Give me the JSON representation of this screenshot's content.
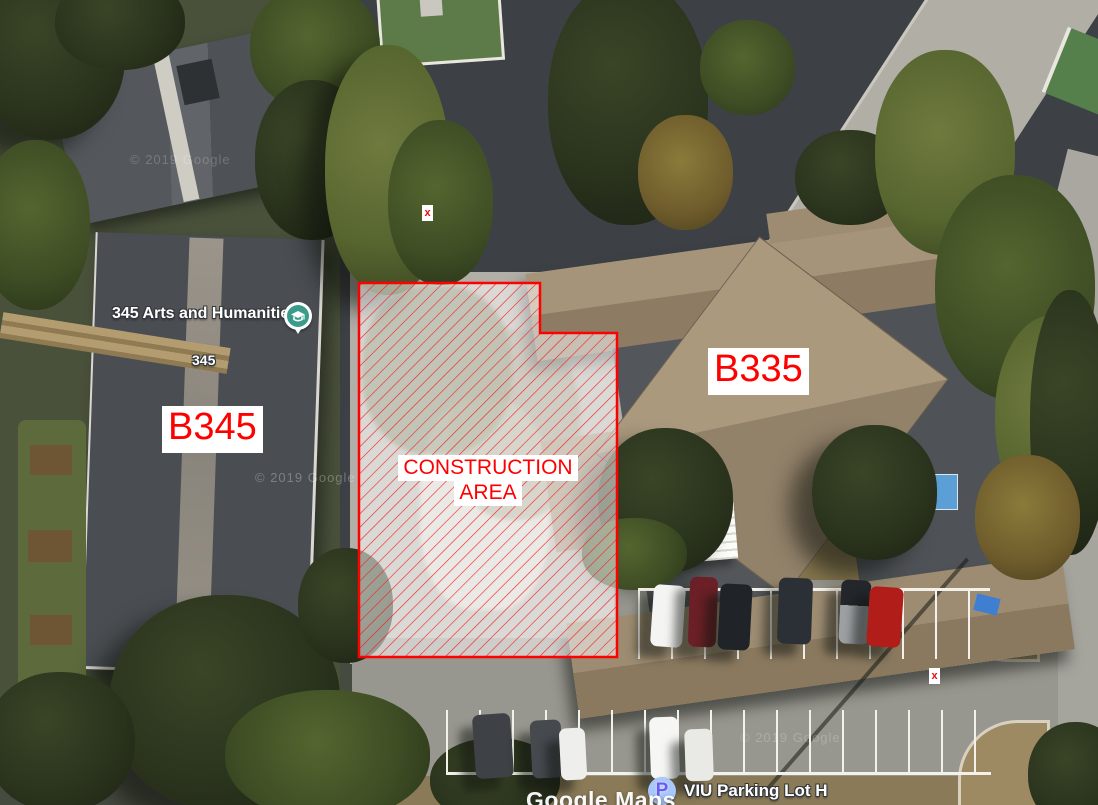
{
  "scene": {
    "view": "aerial-satellite-map",
    "labels": {
      "b345": "B345",
      "b335": "B335",
      "construction": [
        "CONSTRUCTION",
        "AREA"
      ],
      "poi_school_name": "345 Arts and Humanities",
      "building_number_345": "345",
      "poi_parking_name": "VIU Parking Lot H",
      "parking_icon_letter": "P",
      "google_watermark": "Google Maps",
      "copyright_watermark": "© 2019 Google",
      "x_marker": "x"
    },
    "colors": {
      "annotation_red": "#ff0000",
      "label_background": "#ffffff",
      "construction_fill": "rgba(255,255,255,0.5)",
      "school_pin_teal": "#3a9b8a",
      "parking_icon_circle": "#a8c7fb",
      "parking_icon_letter": "#6a5cf0",
      "poi_text_halo": "#33373b"
    }
  }
}
